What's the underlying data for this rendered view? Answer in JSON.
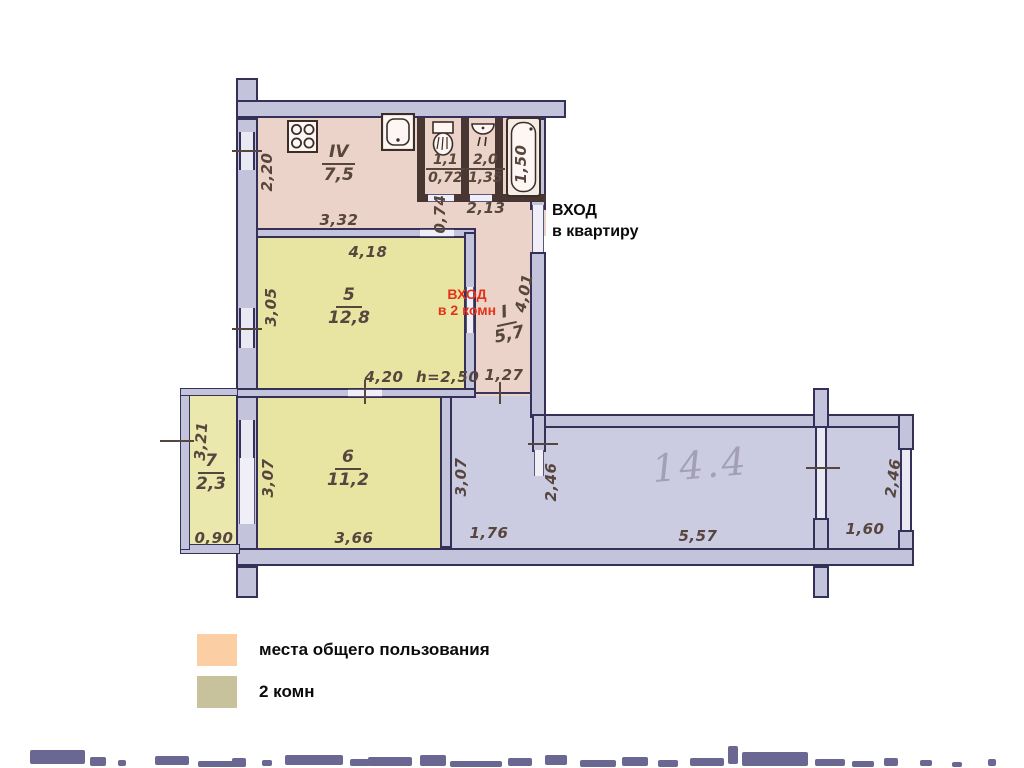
{
  "rooms": {
    "kitchen": {
      "number": "IV",
      "area": "7,5"
    },
    "wc": {
      "top": "1,1",
      "bottom": "0,72"
    },
    "washroom": {
      "top": "2,0",
      "bottom": "1,35"
    },
    "room5": {
      "number": "5",
      "area": "12,8"
    },
    "corridor": {
      "number": "I",
      "area": "5,7"
    },
    "room6": {
      "number": "6",
      "area": "11,2"
    },
    "balcony": {
      "number": "7",
      "area": "2,3"
    }
  },
  "dimensions": {
    "d220": "2,20",
    "d332": "3,32",
    "d074": "0,74",
    "d213": "2,13",
    "d150": "1,50",
    "d418": "4,18",
    "d305": "3,05",
    "d401": "4,01",
    "d420": "4,20",
    "h250": "h=2,50",
    "d127": "1,27",
    "d321": "3,21",
    "d090": "0,90",
    "d307a": "3,07",
    "d366": "3,66",
    "d307b": "3,07",
    "d176": "1,76",
    "d246a": "2,46",
    "d557": "5,57",
    "d246b": "2,46",
    "d160": "1,60"
  },
  "annotations": {
    "entrance_apartment_line1": "ВХОД",
    "entrance_apartment_line2": "в квартиру",
    "entrance_rooms_line1": "ВХОД",
    "entrance_rooms_line2": "в 2 комн",
    "handwritten_area": "14.4"
  },
  "legend": {
    "items": [
      {
        "label": "места общего пользования",
        "color": "#fbcfa3"
      },
      {
        "label": "2 комн",
        "color": "#c7c29b"
      }
    ]
  },
  "icons": {
    "stove": "stove-icon",
    "sink": "sink-icon",
    "toilet": "toilet-icon",
    "washbasin": "washbasin-icon",
    "bathtub": "bathtub-icon"
  },
  "colors": {
    "common_area_fill": "#ecd3c9",
    "rooms_fill": "#e8e5a2",
    "other_fill": "#cbcbe2",
    "wall_fill": "#c4c3dc",
    "wall_line": "#353057",
    "sanitary_wall": "#473631",
    "dimension_text": "#57463e",
    "entrance_red": "#e63119",
    "pencil": "#a39fb7"
  }
}
